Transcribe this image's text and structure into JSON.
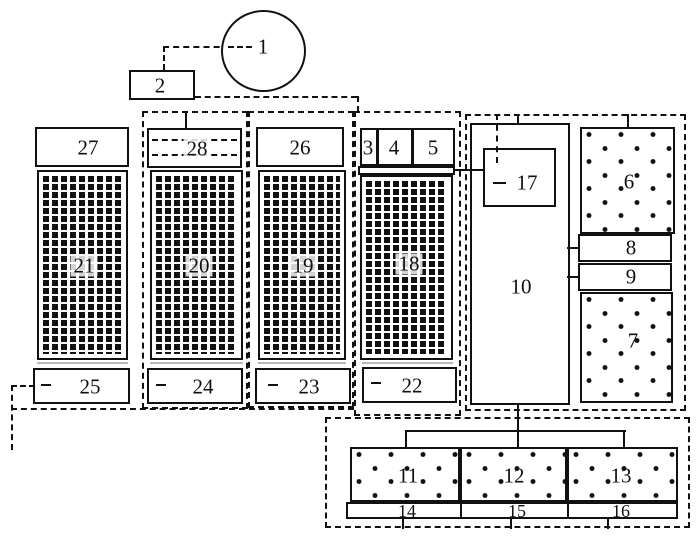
{
  "colors": {
    "ink": "#111111",
    "paper": "#ffffff"
  },
  "nodes": {
    "n1": "1",
    "n2": "2",
    "n3": "3",
    "n4": "4",
    "n5": "5",
    "n6": "6",
    "n7": "7",
    "n8": "8",
    "n9": "9",
    "n10": "10",
    "n11": "11",
    "n12": "12",
    "n13": "13",
    "n14": "14",
    "n15": "15",
    "n16": "16",
    "n17": "17",
    "n18": "18",
    "n19": "19",
    "n20": "20",
    "n21": "21",
    "n22": "22",
    "n23": "23",
    "n24": "24",
    "n25": "25",
    "n26": "26",
    "n27": "27",
    "n28": "28"
  }
}
